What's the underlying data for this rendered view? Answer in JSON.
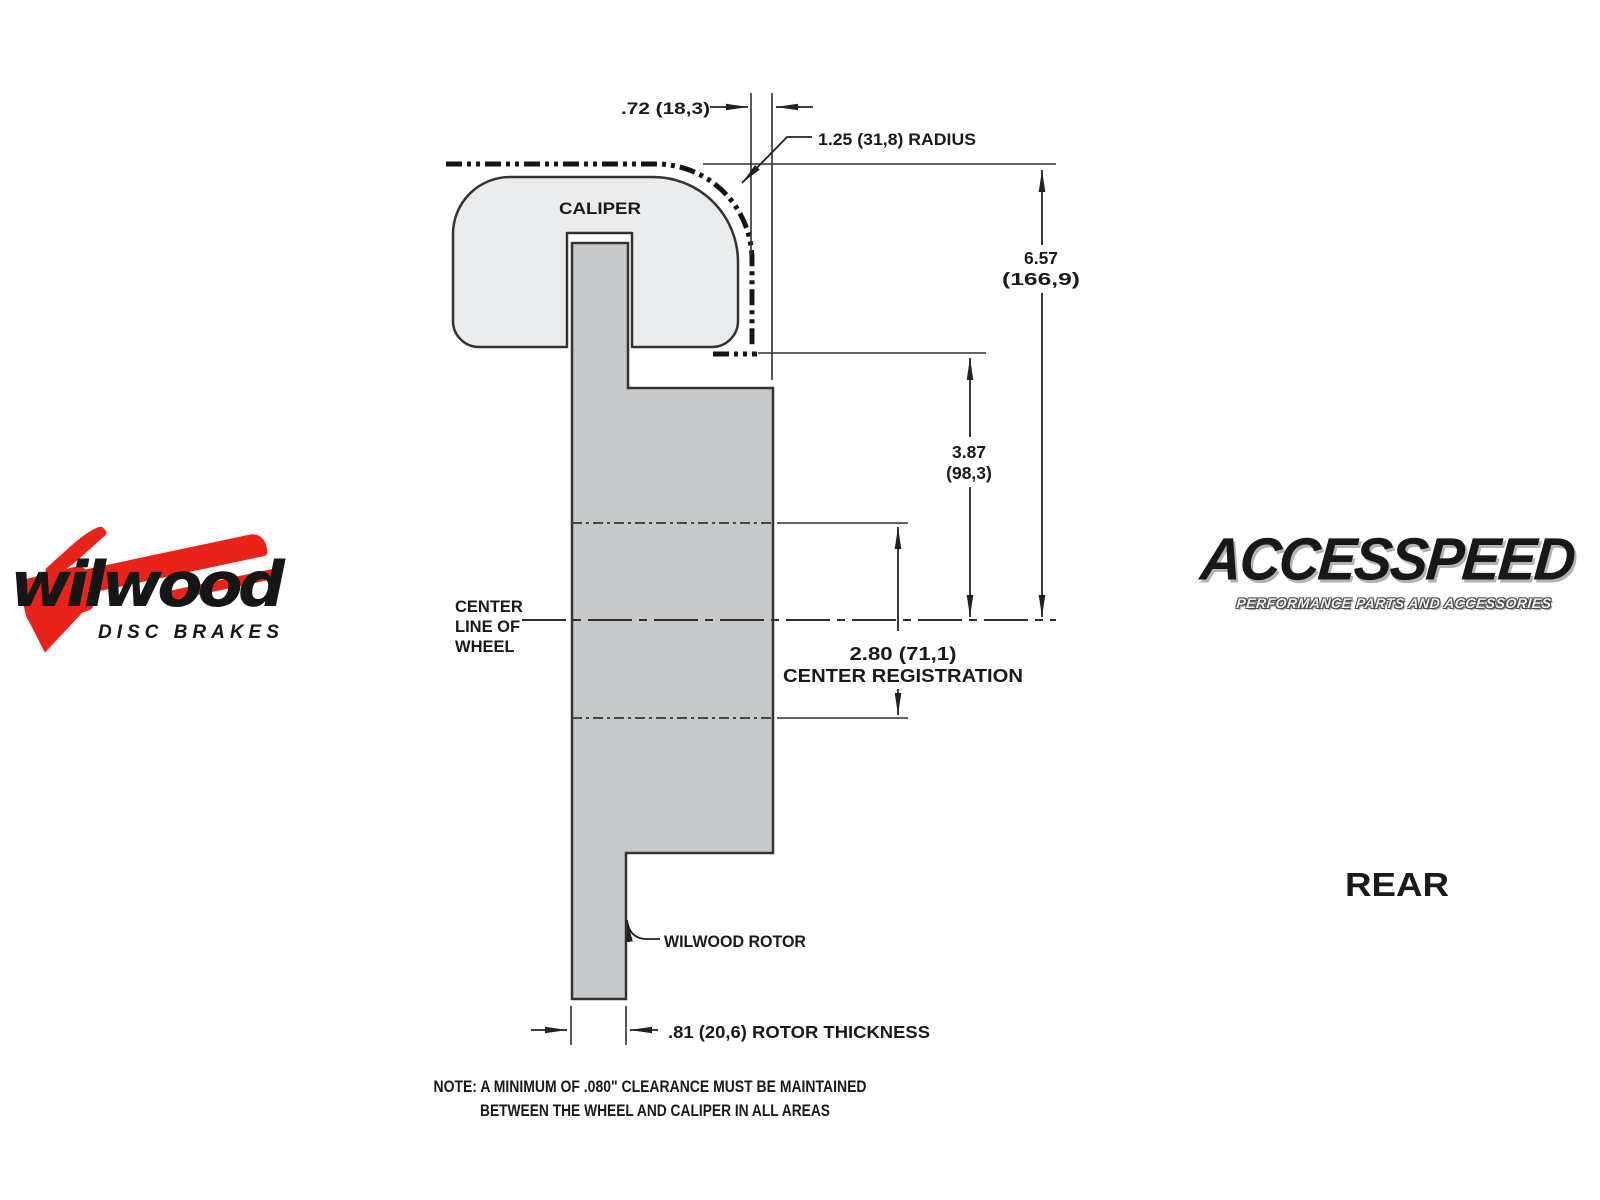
{
  "diagram": {
    "caliper_label": "CALIPER",
    "rotor_label": "WILWOOD ROTOR",
    "view_label": "REAR",
    "centerline_label": {
      "l1": "CENTER",
      "l2": "LINE OF",
      "l3": "WHEEL"
    },
    "dims": {
      "caliper_offset": ".72 (18,3)",
      "caliper_radius": "1.25 (31,8) RADIUS",
      "wheel_to_centerline_in": "6.57",
      "wheel_to_centerline_mm": "(166,9)",
      "face_to_centerline_in": "3.87",
      "face_to_centerline_mm": "(98,3)",
      "center_registration_value": "2.80 (71,1)",
      "center_registration_label": "CENTER REGISTRATION",
      "rotor_thickness": ".81 (20,6) ROTOR THICKNESS"
    },
    "note": {
      "line1": "NOTE: A MINIMUM OF .080\" CLEARANCE MUST BE MAINTAINED",
      "line2": "BETWEEN THE WHEEL AND CALIPER IN ALL AREAS"
    }
  },
  "logos": {
    "wilwood": {
      "name": "wilwood",
      "tagline": "DISC BRAKES"
    },
    "accesspeed": {
      "name": "ACCESSPEED",
      "tagline": "PERFORMANCE PARTS AND ACCESSORIES"
    }
  },
  "colors": {
    "background": "#ffffff",
    "caliper_fill": "#e9ebec",
    "rotor_fill": "#c6c8ca",
    "line": "#2e2e2e",
    "heavy_dash": "#151515",
    "wilwood_red": "#e8231a",
    "logo_black": "#161616",
    "accesspeed_shadow": "#b3b3b3"
  }
}
